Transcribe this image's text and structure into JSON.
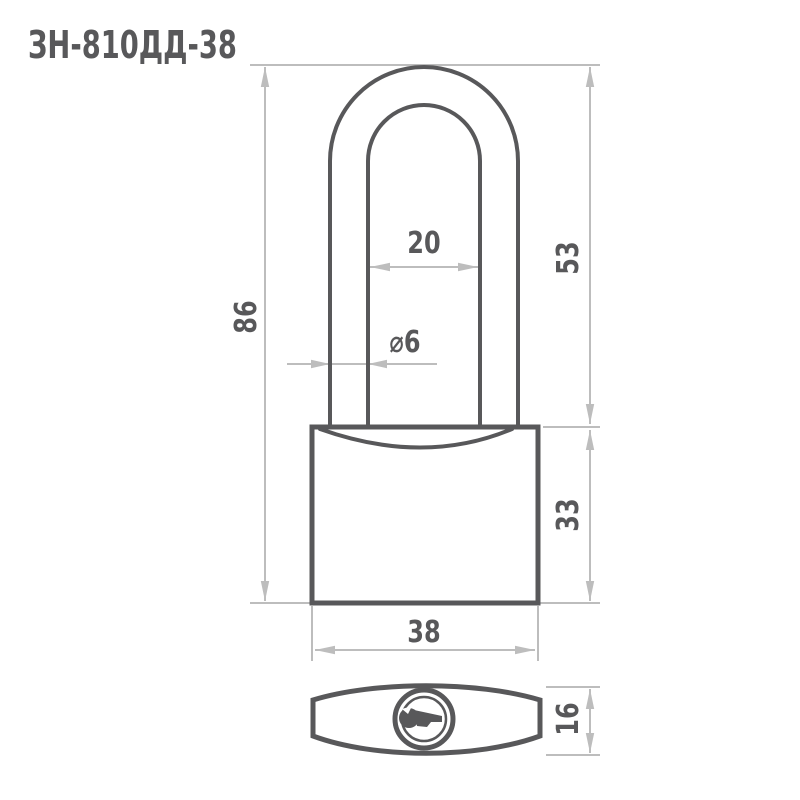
{
  "title": "ЗН-810ДД-38",
  "drawing": {
    "object": "padlock-technical-drawing",
    "dimensions": {
      "total_height": "86",
      "shackle_height": "53",
      "body_height": "33",
      "shackle_inner_width": "20",
      "shackle_wire_diameter": "⌀6",
      "body_width": "38",
      "body_depth": "16"
    },
    "colors": {
      "outline": "#58585a",
      "dimension_lines": "#bdbdbd",
      "label_text": "#58585a",
      "background": "#ffffff"
    }
  }
}
